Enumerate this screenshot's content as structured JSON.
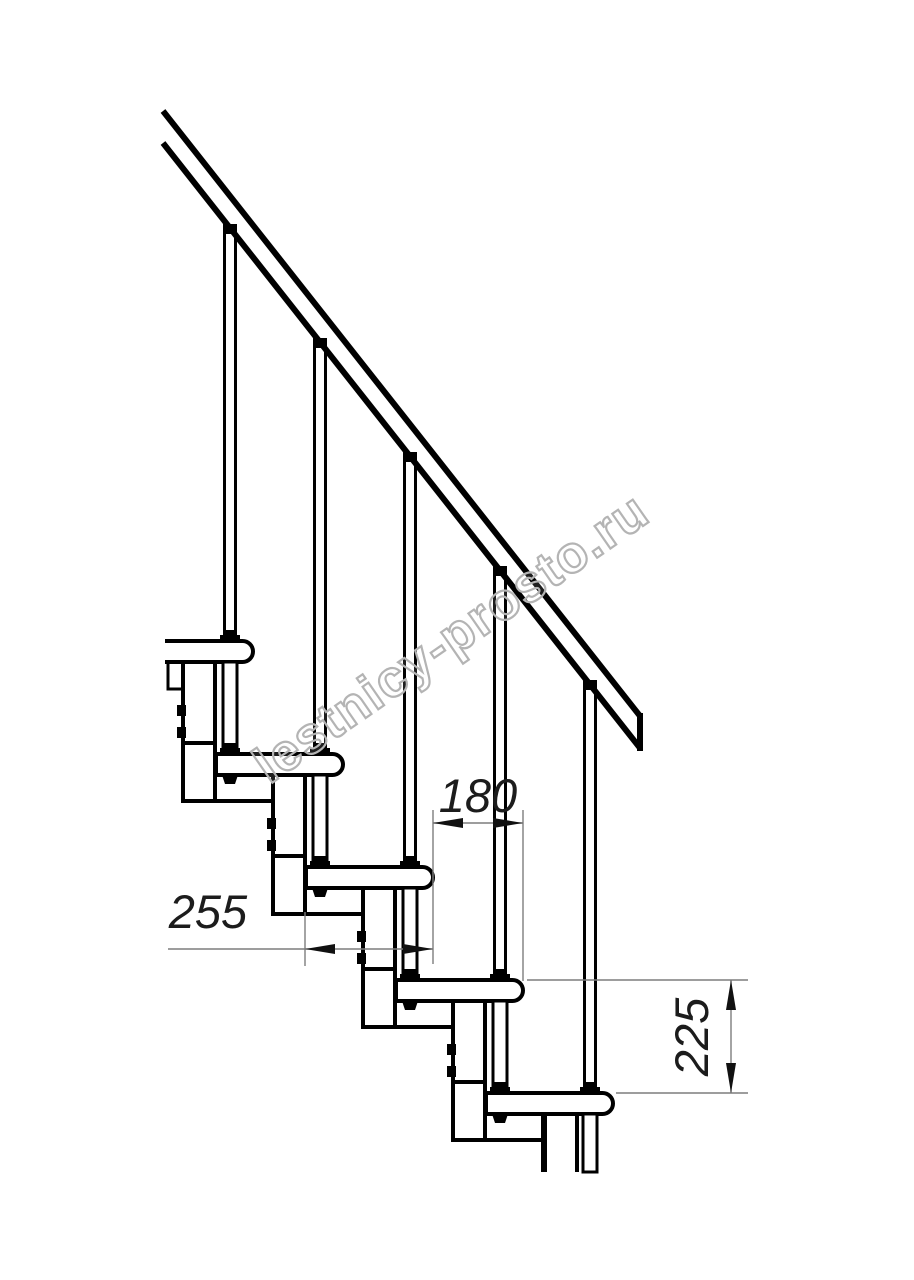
{
  "drawing": {
    "kind_label": "",
    "steps_visible": 5
  },
  "watermark": {
    "text": "lestnicy-prosto.ru",
    "color": "#b4b4b4"
  },
  "dimensions": {
    "run_180": {
      "value": "180",
      "orientation": "horizontal"
    },
    "depth_255": {
      "value": "255",
      "orientation": "horizontal"
    },
    "rise_225": {
      "value": "225",
      "orientation": "vertical"
    }
  },
  "colors": {
    "line": "#000000",
    "thin_line": "#7d7d7d",
    "dimension_text": "#1c1c1c",
    "background": "#ffffff"
  }
}
